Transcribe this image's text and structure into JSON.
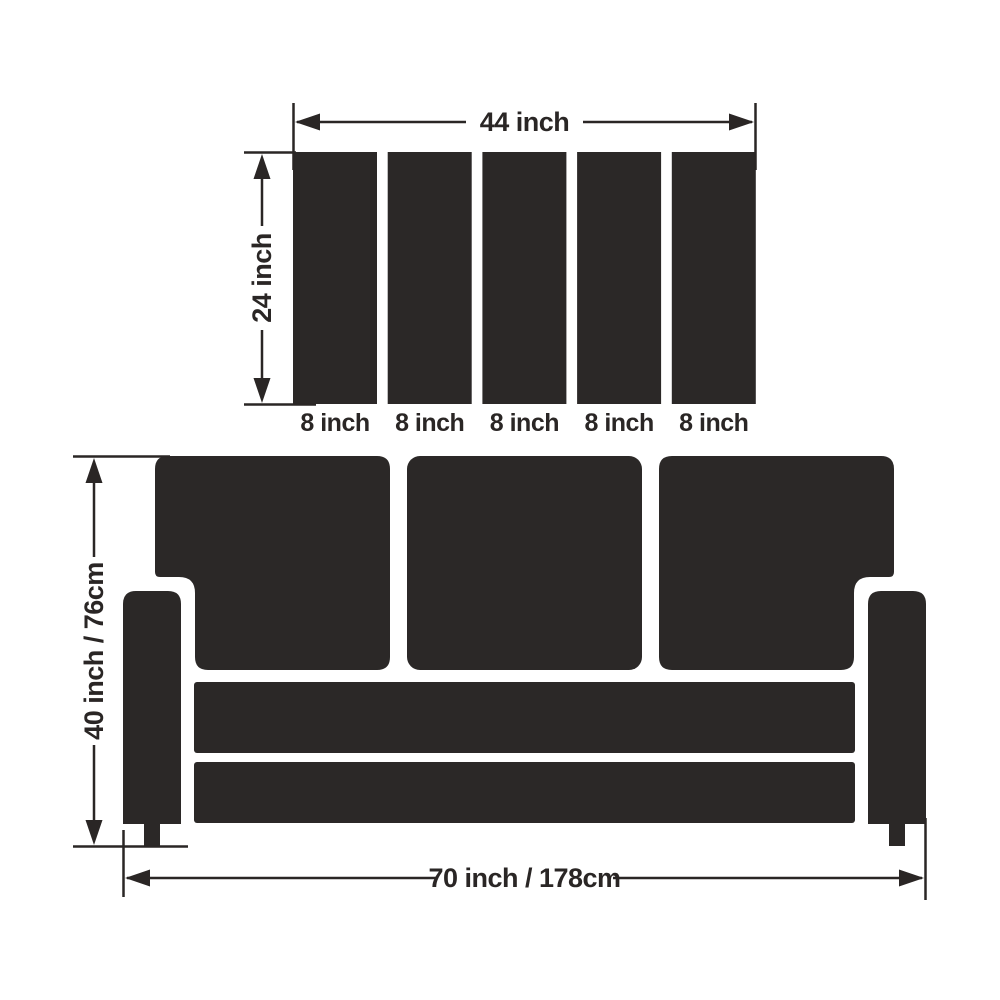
{
  "diagram": {
    "background_color": "#ffffff",
    "ink_color": "#2a2625",
    "fill_color": "#2b2827",
    "top_assembly": {
      "description": "five back cushion slats",
      "slat_count": 5,
      "width_label": "44 inch",
      "height_label": "24 inch",
      "slat_labels": [
        "8 inch",
        "8 inch",
        "8 inch",
        "8 inch",
        "8 inch"
      ]
    },
    "sofa": {
      "description": "three-seat sofa front view silhouette",
      "height_label": "40 inch / 76cm",
      "width_label": "70 inch / 178cm"
    }
  }
}
